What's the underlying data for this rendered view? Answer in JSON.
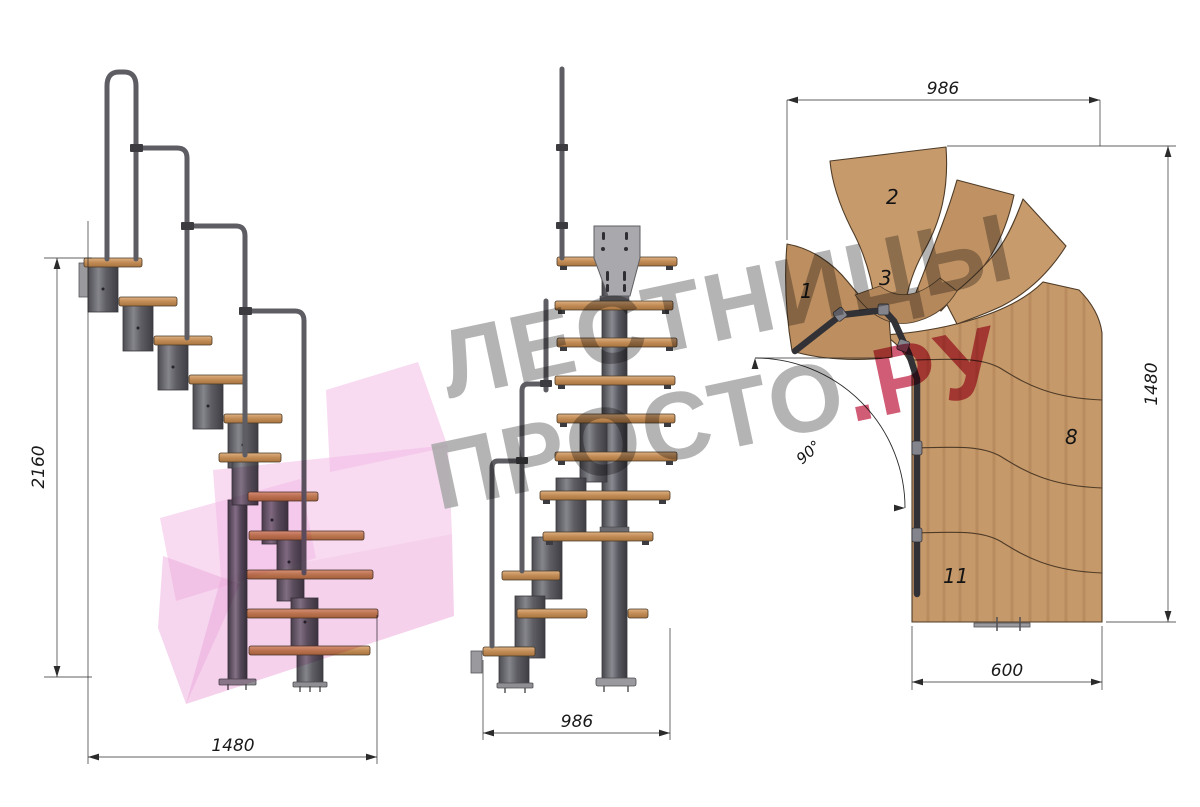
{
  "drawing_title": "Модульная лестница — чертёж (три проекции)",
  "watermark": {
    "line1": "ЛЕСТНИЦЫ",
    "line2_gray": "ПРОСТО",
    "line2_red": ".РУ",
    "gray_color": "#a7a7a7",
    "red_color": "#c9405f",
    "pink_color": "#f3bce6"
  },
  "colors": {
    "wood": "#c6996a",
    "wood_dark": "#b5885c",
    "metal_dark": "#55555a",
    "metal_light": "#9a9a9e",
    "rail": "#5d5d63",
    "dim_line": "#2b2b2b",
    "label": "#1a1a1a"
  },
  "views": {
    "side": {
      "name": "Вид сбоку",
      "dims": {
        "height": "2160",
        "length": "1480"
      }
    },
    "front": {
      "name": "Вид спереди",
      "dims": {
        "width": "986"
      }
    },
    "plan": {
      "name": "Вид сверху",
      "dims": {
        "top_width": "986",
        "right_height": "1480",
        "bottom_width": "600",
        "turn_angle": "90°"
      },
      "steps": [
        {
          "n": "1"
        },
        {
          "n": "2"
        },
        {
          "n": "3"
        },
        {
          "n": "8"
        },
        {
          "n": "11"
        }
      ]
    }
  }
}
